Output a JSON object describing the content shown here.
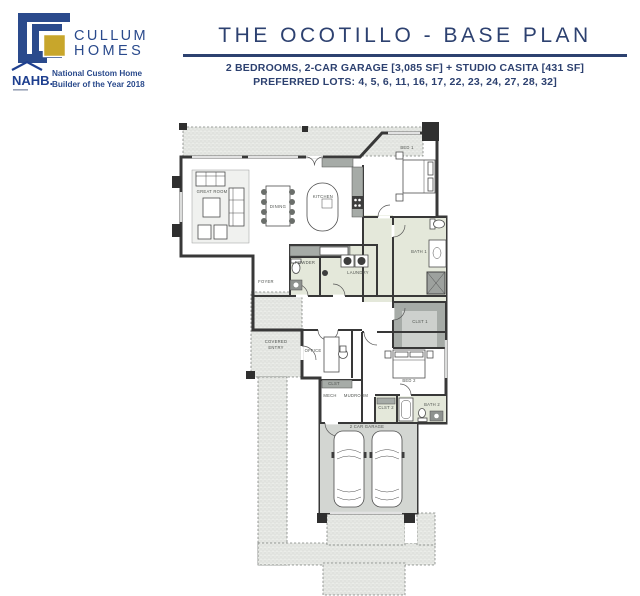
{
  "header": {
    "logo": {
      "name_line1": "CULLUM",
      "name_line2": "HOMES",
      "nahb": "NAHB.",
      "award_line1": "National Custom Home",
      "award_line2": "Builder of the Year 2018"
    },
    "title": "THE OCOTILLO - BASE PLAN",
    "subtitle_line1": "2 BEDROOMS, 2-CAR GARAGE [3,085 SF] + STUDIO CASITA [431 SF]",
    "subtitle_line2": "PREFERRED LOTS: 4, 5, 6, 11, 16, 17, 22, 23, 24, 27, 28, 32]"
  },
  "colors": {
    "brand_blue": "#2a4a8c",
    "brand_gold": "#c8a62b",
    "title_navy": "#2d4170",
    "wall": "#383838",
    "floor": "#d9dcd8",
    "tile": "#e4e8da",
    "carpet": "#c6c9c6",
    "garage_floor": "#d3d6d2"
  },
  "floorplan": {
    "rooms": [
      {
        "label": "GREAT ROOM",
        "x": 212,
        "y": 193
      },
      {
        "label": "DINING",
        "x": 278,
        "y": 208
      },
      {
        "label": "KITCHEN",
        "x": 323,
        "y": 198
      },
      {
        "label": "BED 1",
        "x": 407,
        "y": 149
      },
      {
        "label": "BATH 1",
        "x": 419,
        "y": 253
      },
      {
        "label": "CLST 1",
        "x": 420,
        "y": 323
      },
      {
        "label": "POWDER",
        "x": 305,
        "y": 264
      },
      {
        "label": "LAUNDRY",
        "x": 358,
        "y": 274
      },
      {
        "label": "FOYER",
        "x": 266,
        "y": 283
      },
      {
        "label": "COVERED",
        "x": 276,
        "y": 343
      },
      {
        "label": "ENTRY",
        "x": 276,
        "y": 349
      },
      {
        "label": "OFFICE",
        "x": 313,
        "y": 352
      },
      {
        "label": "CLST",
        "x": 334,
        "y": 385
      },
      {
        "label": "MECH",
        "x": 330,
        "y": 397
      },
      {
        "label": "MUDROOM",
        "x": 356,
        "y": 397
      },
      {
        "label": "BED 2",
        "x": 409,
        "y": 382
      },
      {
        "label": "CLST 2",
        "x": 386,
        "y": 409
      },
      {
        "label": "BATH 2",
        "x": 432,
        "y": 406
      },
      {
        "label": "2 CAR GARAGE",
        "x": 367,
        "y": 428
      }
    ]
  }
}
